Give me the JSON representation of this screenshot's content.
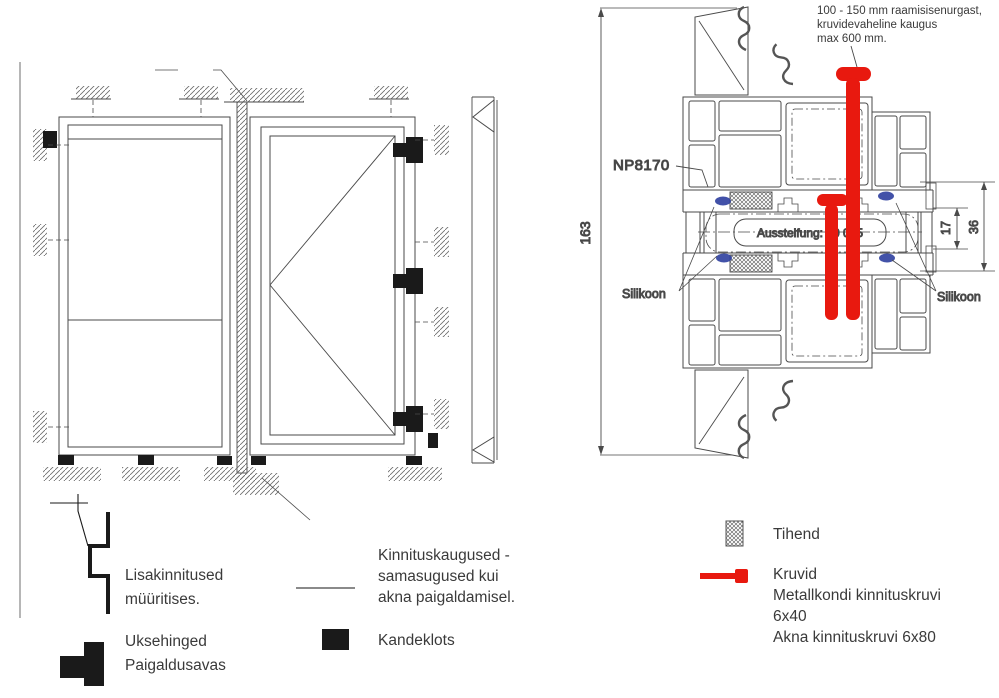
{
  "colors": {
    "red": "#e8190f",
    "blue": "#2e3f9f",
    "line": "#4a4a4a",
    "text": "#3a3a3a"
  },
  "section": {
    "note": "100 - 150 mm raamisisenurgast,\nkruvidevaheline kaugus\nmax 600 mm.",
    "profile_label": "NP8170",
    "dim_total": "163",
    "dim_inner": "17",
    "dim_outer": "36",
    "stiffener": "Aussteifung: 40 015",
    "silicone_left": "Silikoon",
    "silicone_right": "Silikoon"
  },
  "legend": {
    "left": [
      {
        "label": "Lisakinnitused\nmüüritises."
      },
      {
        "label": "Uksehinged\nPaigaldusavas"
      }
    ],
    "middle": [
      {
        "label": "Kinnituskaugused -\nsamasugused kui\nakna paigaldamisel."
      },
      {
        "label": "Kandeklots"
      }
    ],
    "right": [
      {
        "label": "Tihend"
      },
      {
        "label": "Kruvid\nMetallkondi kinnituskruvi\n6x40\nAkna kinnituskruvi 6x80"
      }
    ]
  }
}
